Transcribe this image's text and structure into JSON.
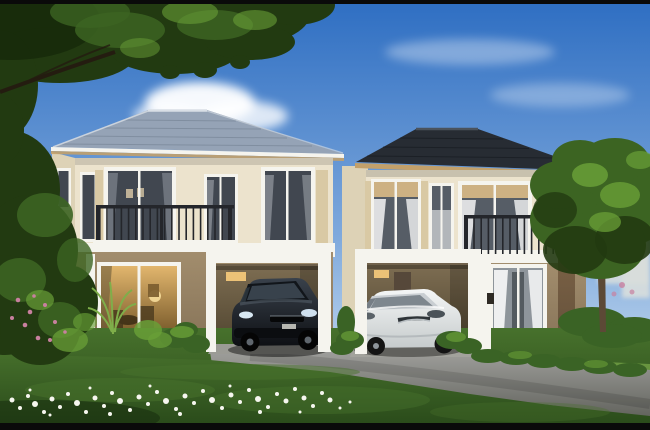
{
  "meta": {
    "kind": "natural-image",
    "description": "Architectural 3D rendering of two adjoining two-storey suburban houses with open carports. A black sedan is parked under the left house, a white sedan under the right house. Cream upper walls, taupe lower walls, white trim, dark balcony railings. Blue sky with clouds, tree canopy overhanging the top-left, garden tree at right, green lawn with scattered white flowers in the foreground and a grey driveway sweeping to the lower right. Thin black letterbox bars at top and bottom."
  },
  "scene": {
    "objects": [
      "sky with clouds",
      "overhanging tree canopy (top-left)",
      "left two-storey house with grey-blue hip roof, balcony and carport",
      "right two-storey house with dark charcoal hip roof, balcony and carport",
      "black sedan parked in left carport",
      "white sedan parked in right carport",
      "lit sliding glass doors",
      "garden tree and hedges (right)",
      "foreground lawn with white flowers",
      "grey driveway",
      "pink flowering shrubs (bottom-left)"
    ]
  },
  "colors": {
    "frame_bar": "#0a0a0a",
    "sky_top": "#2e6ec2",
    "sky_mid": "#7fa9dc",
    "sky_pale": "#dcebf6",
    "cloud": "#ffffff",
    "distant": "#d9dedc",
    "canopy_dark": "#223a11",
    "canopy_deep": "#142708",
    "canopy_mid": "#3c6422",
    "canopy_light": "#699f37",
    "trunk": "#5c4936",
    "left_roof": "#95a3b6",
    "left_roof_edge": "#d9dfe6",
    "right_roof": "#272c33",
    "right_roof_edge": "#4a525c",
    "fascia": "#c2a06a",
    "wall_cream": "#ece3cd",
    "wall_shade": "#ddd2b6",
    "trim_white": "#f5f4ee",
    "wall_taupe": "#a28d6d",
    "wall_taupe_deep": "#857257",
    "railing": "#24262b",
    "glass_dark": "#414750",
    "glass_cool": "#565d66",
    "blind_tan": "#cdb183",
    "lattice_tan": "#d9c9a4",
    "glass_warm_light": "#e2b66e",
    "glass_warm_dark": "#6e5124",
    "carport_in_light": "#7d6d52",
    "carport_in_dark": "#4e432e",
    "lamp_glow": "#ecc277",
    "pillar_brown": "#84684a",
    "pillar_brown_dark": "#63503a",
    "grass_light": "#6d9a42",
    "grass_mid": "#47712c",
    "grass_dark": "#2b4c1b",
    "hedge": "#3a6325",
    "drive_light": "#a3a3a0",
    "drive_dark": "#64655f",
    "paving": "#c8bda4",
    "car_black_hi": "#39414b",
    "car_black": "#0e1014",
    "car_white": "#f4f6f6",
    "car_white_shade": "#c6cbcc",
    "flower_white": "#f6f6ef",
    "flower_pink": "#c8809f"
  }
}
